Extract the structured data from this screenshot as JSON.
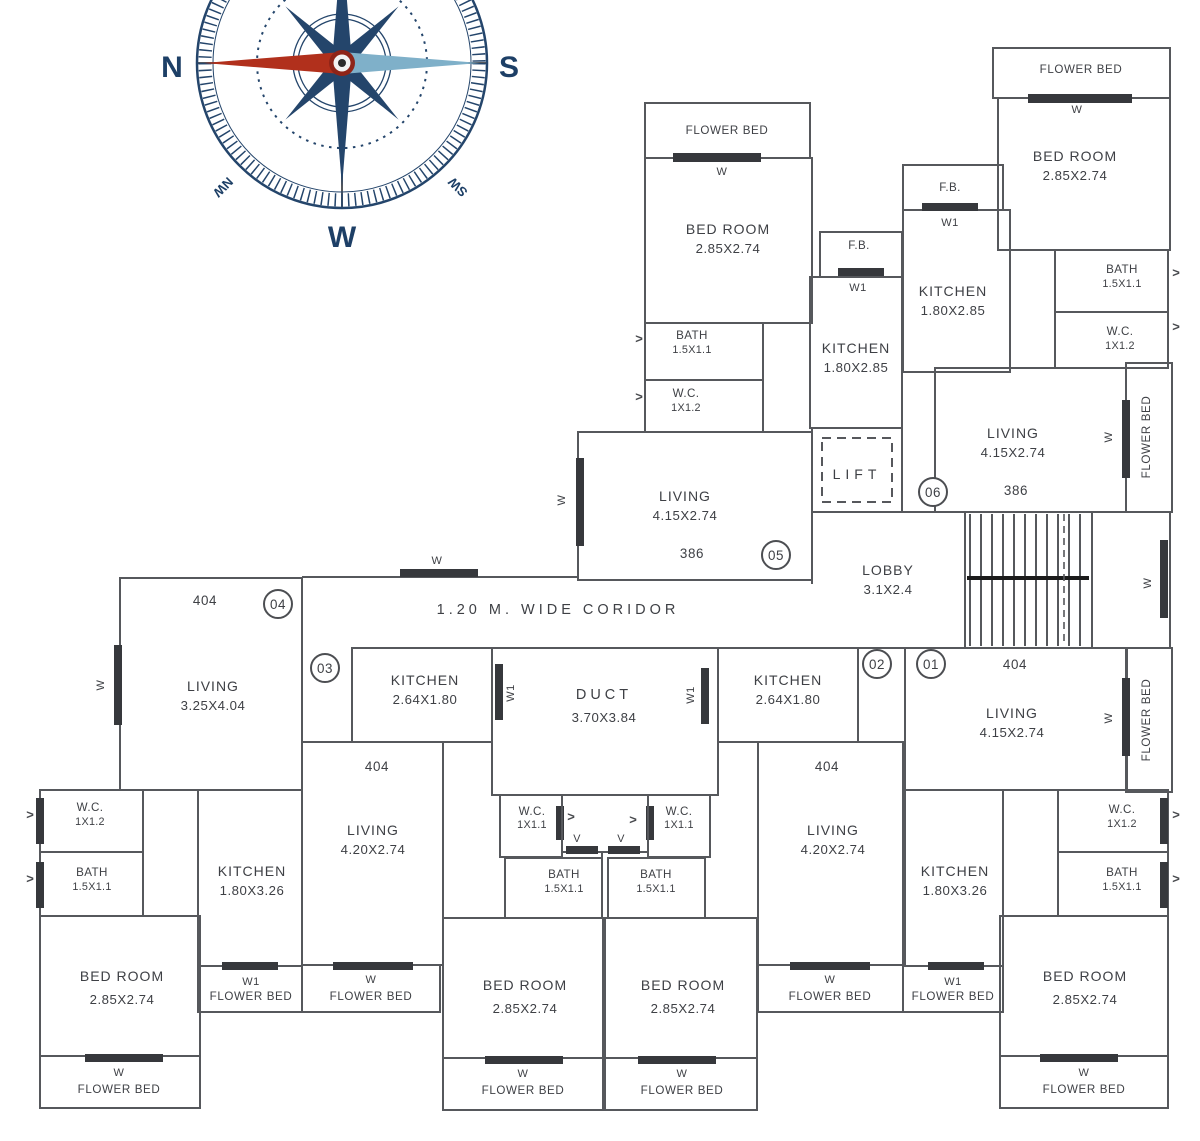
{
  "colors": {
    "wall": "#56585c",
    "window_bar": "#36383c",
    "text": "#3e4045",
    "compass_navy": "#24456b",
    "needle_red": "#b1301c",
    "needle_blue": "#7fb0c9",
    "background": "#ffffff"
  },
  "icons": {
    "door_arrow": ">"
  },
  "compass": {
    "north": "N",
    "south": "S",
    "west": "W",
    "northwest": "NW",
    "southwest": "SW"
  },
  "corridor": {
    "label": "1.20 M. WIDE CORIDOR",
    "window": "W"
  },
  "lobby": {
    "name": "LOBBY",
    "dims": "3.1X2.4"
  },
  "lift": {
    "name": "LIFT"
  },
  "stairwell": {
    "window": "W"
  },
  "duct": {
    "name": "DUCT",
    "dims": "3.70X3.84",
    "window_left": "W1",
    "window_right": "W1",
    "vent_left": "V",
    "vent_right": "V"
  },
  "unit05": {
    "number": "05",
    "area": "386",
    "flower_bed_top": {
      "label": "FLOWER BED",
      "window": "W"
    },
    "bedroom": {
      "name": "BED ROOM",
      "dims": "2.85X2.74"
    },
    "bath": {
      "name": "BATH",
      "dims": "1.5X1.1"
    },
    "wc": {
      "name": "W.C.",
      "dims": "1X1.2"
    },
    "living": {
      "name": "LIVING",
      "dims": "4.15X2.74",
      "window": "W"
    },
    "fb": {
      "label": "F.B.",
      "window": "W1"
    },
    "kitchen": {
      "name": "KITCHEN",
      "dims": "1.80X2.85"
    }
  },
  "unit06": {
    "number": "06",
    "area": "386",
    "flower_bed_top": {
      "label": "FLOWER BED",
      "window": "W"
    },
    "bedroom": {
      "name": "BED ROOM",
      "dims": "2.85X2.74"
    },
    "fb": {
      "label": "F.B.",
      "window": "W1"
    },
    "kitchen": {
      "name": "KITCHEN",
      "dims": "1.80X2.85"
    },
    "bath": {
      "name": "BATH",
      "dims": "1.5X1.1"
    },
    "wc": {
      "name": "W.C.",
      "dims": "1X1.2"
    },
    "living": {
      "name": "LIVING",
      "dims": "4.15X2.74"
    },
    "flower_bed_side": {
      "label": "FLOWER BED",
      "window": "W"
    }
  },
  "unit04": {
    "number": "04",
    "area": "404",
    "living": {
      "name": "LIVING",
      "dims": "3.25X4.04",
      "window": "W"
    },
    "wc": {
      "name": "W.C.",
      "dims": "1X1.2"
    },
    "bath": {
      "name": "BATH",
      "dims": "1.5X1.1"
    },
    "kitchen": {
      "name": "KITCHEN",
      "dims": "1.80X3.26"
    },
    "bedroom": {
      "name": "BED ROOM",
      "dims": "2.85X2.74"
    },
    "flower_bed_w1": {
      "window": "W1",
      "label": "FLOWER BED"
    },
    "flower_bed_w": {
      "window": "W",
      "label": "FLOWER BED"
    }
  },
  "unit03": {
    "number": "03",
    "area": "404",
    "kitchen": {
      "name": "KITCHEN",
      "dims": "2.64X1.80"
    },
    "living": {
      "name": "LIVING",
      "dims": "4.20X2.74"
    },
    "flower_bed_living": {
      "window": "W",
      "label": "FLOWER BED"
    },
    "wc": {
      "name": "W.C.",
      "dims": "1X1.1"
    },
    "bath": {
      "name": "BATH",
      "dims": "1.5X1.1"
    },
    "bedroom": {
      "name": "BED ROOM",
      "dims": "2.85X2.74"
    },
    "flower_bed_bedroom": {
      "window": "W",
      "label": "FLOWER BED"
    }
  },
  "unit02": {
    "number": "02",
    "area": "404",
    "kitchen": {
      "name": "KITCHEN",
      "dims": "2.64X1.80"
    },
    "living": {
      "name": "LIVING",
      "dims": "4.20X2.74"
    },
    "flower_bed_living": {
      "window": "W",
      "label": "FLOWER BED"
    },
    "wc": {
      "name": "W.C.",
      "dims": "1X1.1"
    },
    "bath": {
      "name": "BATH",
      "dims": "1.5X1.1"
    },
    "bedroom": {
      "name": "BED ROOM",
      "dims": "2.85X2.74"
    },
    "flower_bed_bedroom": {
      "window": "W",
      "label": "FLOWER BED"
    }
  },
  "unit01": {
    "number": "01",
    "area": "404",
    "living": {
      "name": "LIVING",
      "dims": "4.15X2.74"
    },
    "flower_bed_side": {
      "label": "FLOWER BED",
      "window": "W"
    },
    "wc": {
      "name": "W.C.",
      "dims": "1X1.2"
    },
    "bath": {
      "name": "BATH",
      "dims": "1.5X1.1"
    },
    "kitchen": {
      "name": "KITCHEN",
      "dims": "1.80X3.26"
    },
    "flower_bed_w1": {
      "window": "W1",
      "label": "FLOWER BED"
    },
    "bedroom": {
      "name": "BED ROOM",
      "dims": "2.85X2.74"
    },
    "flower_bed_w": {
      "window": "W",
      "label": "FLOWER BED"
    }
  }
}
